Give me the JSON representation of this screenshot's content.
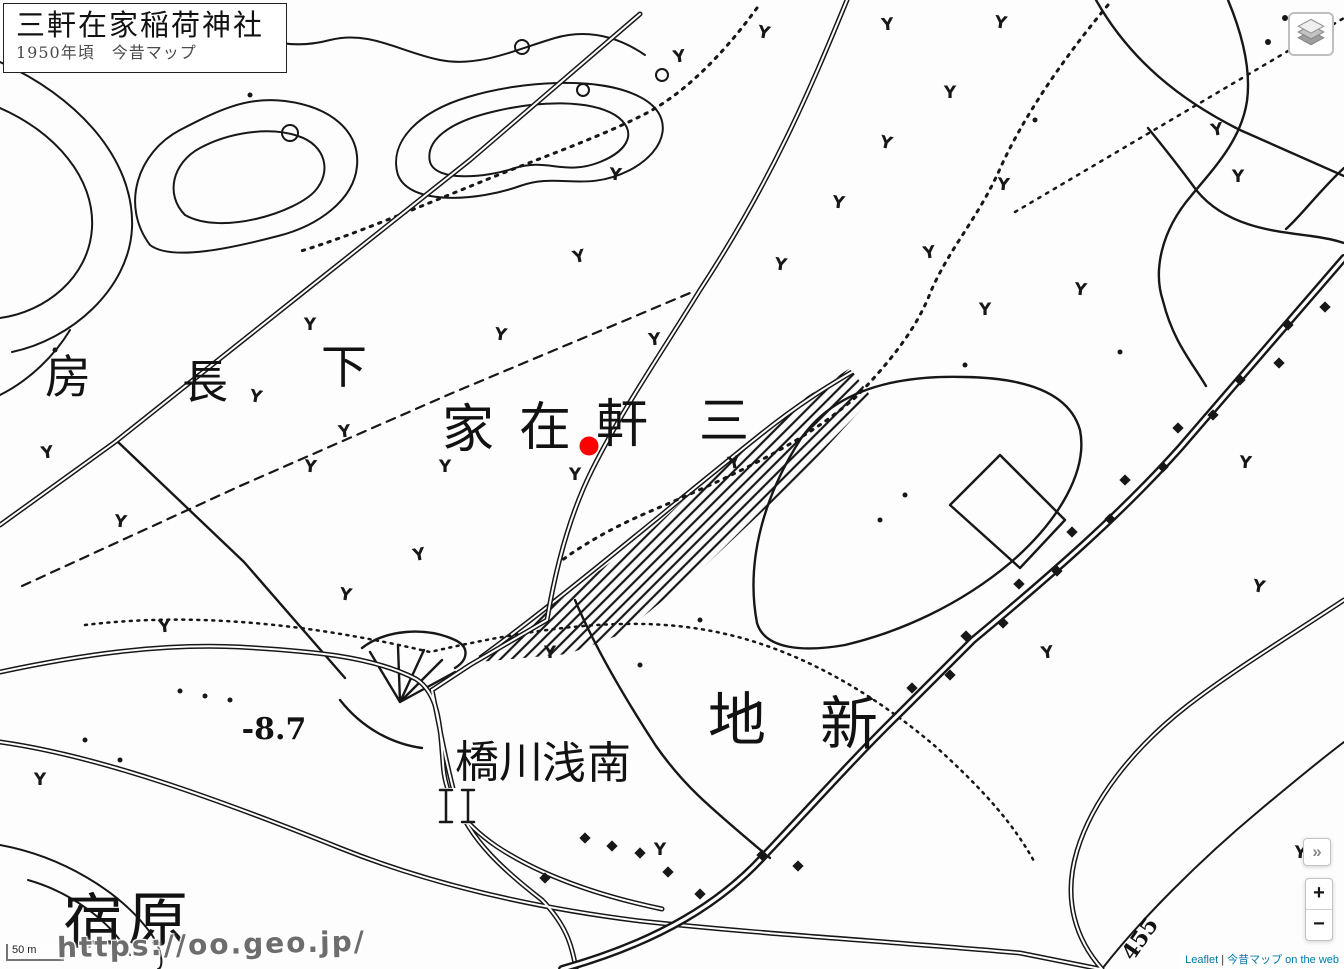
{
  "title_box": {
    "title": "三軒在家稲荷神社",
    "subtitle": "1950年頃　今昔マップ"
  },
  "controls": {
    "expand_label": "»",
    "zoom_in_label": "+",
    "zoom_out_label": "−"
  },
  "scale_bar": {
    "label": "50 m"
  },
  "watermark": {
    "text": "https://oo.geo.jp/"
  },
  "attribution": {
    "leaflet_label": "Leaflet",
    "separator": " | ",
    "source_label": "今昔マップ on the web"
  },
  "colors": {
    "marker_red": "#ff0000",
    "link_blue": "#0078A8",
    "map_ink": "#171717"
  },
  "map": {
    "marker": {
      "x": 589,
      "y": 446,
      "radius": 9.5,
      "color": "#ff0000"
    },
    "labels": [
      {
        "t": "家",
        "x": 468,
        "y": 447,
        "s": 52
      },
      {
        "t": "在",
        "x": 545,
        "y": 445,
        "s": 52
      },
      {
        "t": "軒",
        "x": 622,
        "y": 442,
        "s": 52
      },
      {
        "t": "三",
        "x": 724,
        "y": 438,
        "s": 50
      },
      {
        "t": "房",
        "x": 68,
        "y": 393,
        "s": 46
      },
      {
        "t": "長",
        "x": 205,
        "y": 398,
        "s": 46
      },
      {
        "t": "下",
        "x": 344,
        "y": 383,
        "s": 46
      },
      {
        "t": "地",
        "x": 737,
        "y": 740,
        "s": 58
      },
      {
        "t": "新",
        "x": 849,
        "y": 744,
        "s": 58
      },
      {
        "t": "橋",
        "x": 477,
        "y": 777,
        "s": 44
      },
      {
        "t": "川",
        "x": 521,
        "y": 777,
        "s": 44
      },
      {
        "t": "浅",
        "x": 564,
        "y": 778,
        "s": 44
      },
      {
        "t": "南",
        "x": 609,
        "y": 778,
        "s": 44
      },
      {
        "t": "宿",
        "x": 93,
        "y": 943,
        "s": 60
      },
      {
        "t": "原",
        "x": 158,
        "y": 941,
        "s": 60
      },
      {
        "t": "-8.7",
        "x": 274,
        "y": 739,
        "s": 30,
        "b": 1
      },
      {
        "t": "455",
        "x": 1146,
        "y": 943,
        "s": 22,
        "r": -55,
        "b": 1
      }
    ],
    "symbol_glyph": "Y",
    "symbols": [
      [
        763,
        38,
        10
      ],
      [
        888,
        30,
        -5
      ],
      [
        1000,
        28,
        8
      ],
      [
        680,
        62,
        -8
      ],
      [
        950,
        98,
        0
      ],
      [
        885,
        148,
        12
      ],
      [
        838,
        208,
        6
      ],
      [
        1003,
        190,
        5
      ],
      [
        930,
        258,
        -8
      ],
      [
        1218,
        135,
        -10
      ],
      [
        1080,
        295,
        6
      ],
      [
        985,
        315,
        0
      ],
      [
        580,
        262,
        -12
      ],
      [
        500,
        340,
        8
      ],
      [
        310,
        330,
        0
      ],
      [
        255,
        402,
        10
      ],
      [
        345,
        437,
        -6
      ],
      [
        310,
        472,
        5
      ],
      [
        575,
        480,
        0
      ],
      [
        735,
        468,
        -10
      ],
      [
        120,
        527,
        6
      ],
      [
        165,
        632,
        -5
      ],
      [
        345,
        600,
        8
      ],
      [
        550,
        658,
        0
      ],
      [
        1048,
        658,
        -8
      ],
      [
        1245,
        468,
        5
      ],
      [
        1258,
        592,
        10
      ],
      [
        445,
        472,
        0
      ],
      [
        655,
        345,
        -5
      ],
      [
        780,
        270,
        8
      ],
      [
        48,
        458,
        -8
      ],
      [
        660,
        855,
        0
      ],
      [
        1300,
        858,
        5
      ],
      [
        1238,
        182,
        0
      ],
      [
        420,
        560,
        -10
      ],
      [
        615,
        180,
        5
      ],
      [
        40,
        785,
        0
      ]
    ]
  }
}
